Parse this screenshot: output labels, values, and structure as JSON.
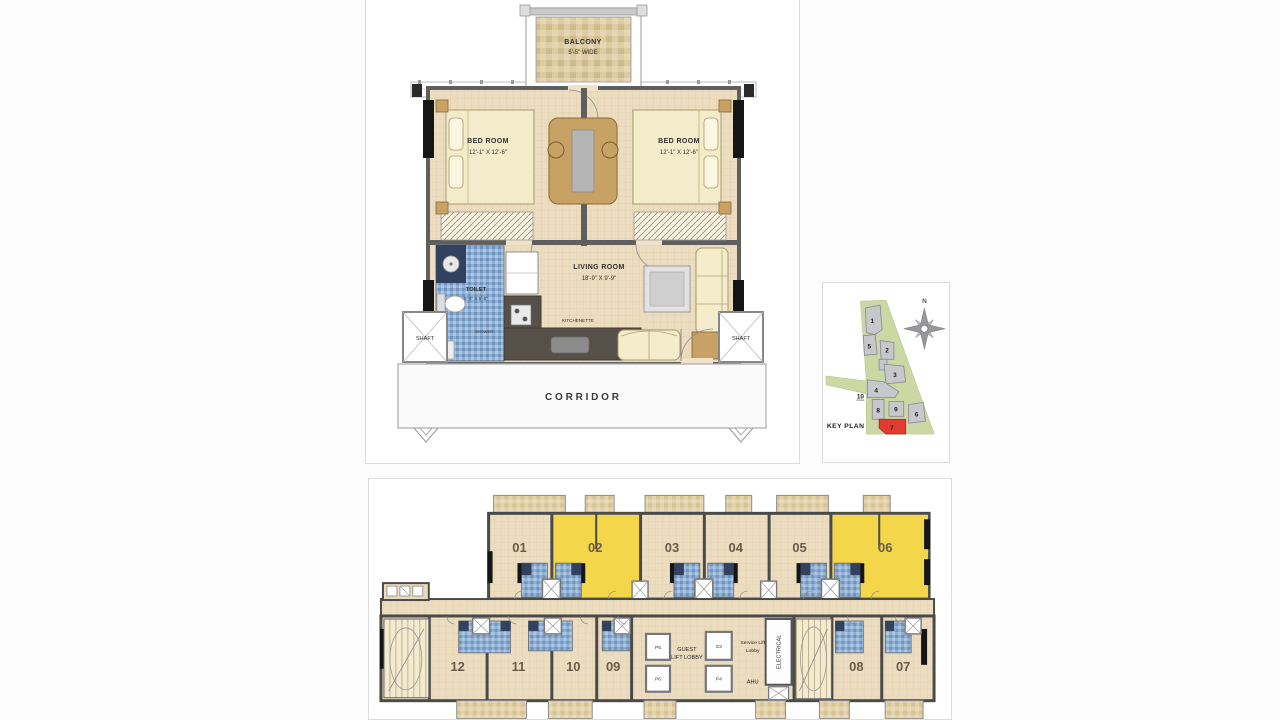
{
  "unit_plan": {
    "balcony": {
      "name": "BALCONY",
      "dim": "5'-5\" WIDE"
    },
    "bedroom_left": {
      "name": "BED ROOM",
      "dim": "12'-1\" X 12'-6\""
    },
    "bedroom_right": {
      "name": "BED ROOM",
      "dim": "12'-1\" X 12'-6\""
    },
    "toilet": {
      "name": "TOILET",
      "dim": "5'-5\" X 9'-5\""
    },
    "shower": "SHOWER",
    "living": {
      "name": "LIVING ROOM",
      "dim": "18'-9\" X 9'-9\""
    },
    "kitchenette": "KITCHENETTE",
    "shaft_left": "SHAFT",
    "shaft_right": "SHAFT",
    "corridor": "C O R R I D O R"
  },
  "key_plan": {
    "label": "KEY PLAN",
    "north": "N",
    "buildings": [
      "1",
      "2",
      "3",
      "4",
      "5",
      "6",
      "8",
      "9",
      "10"
    ],
    "highlighted": "7",
    "colors": {
      "site": "#ccd8a4",
      "building": "#c7c7cc",
      "highlight": "#e23b30"
    }
  },
  "floor_plate": {
    "top_units": [
      "01",
      "02",
      "03",
      "04",
      "05",
      "06"
    ],
    "bottom_units": [
      "12",
      "11",
      "10",
      "09",
      "08",
      "07"
    ],
    "highlighted_units": [
      "02",
      "06"
    ],
    "lifts": [
      "P5",
      "P6",
      "S3",
      "P4"
    ],
    "guest_lift_lobby_lines": [
      "GUEST",
      "LIFT LOBBY"
    ],
    "service_lift_lobby_lines": [
      "Service Lift",
      "Lobby"
    ],
    "ahu": "AHU",
    "electrical": "ELECTRICAL",
    "colors": {
      "highlight": "#f3d64a",
      "floor": "#ecddc0",
      "bathroom": "#8fb0d4"
    }
  }
}
